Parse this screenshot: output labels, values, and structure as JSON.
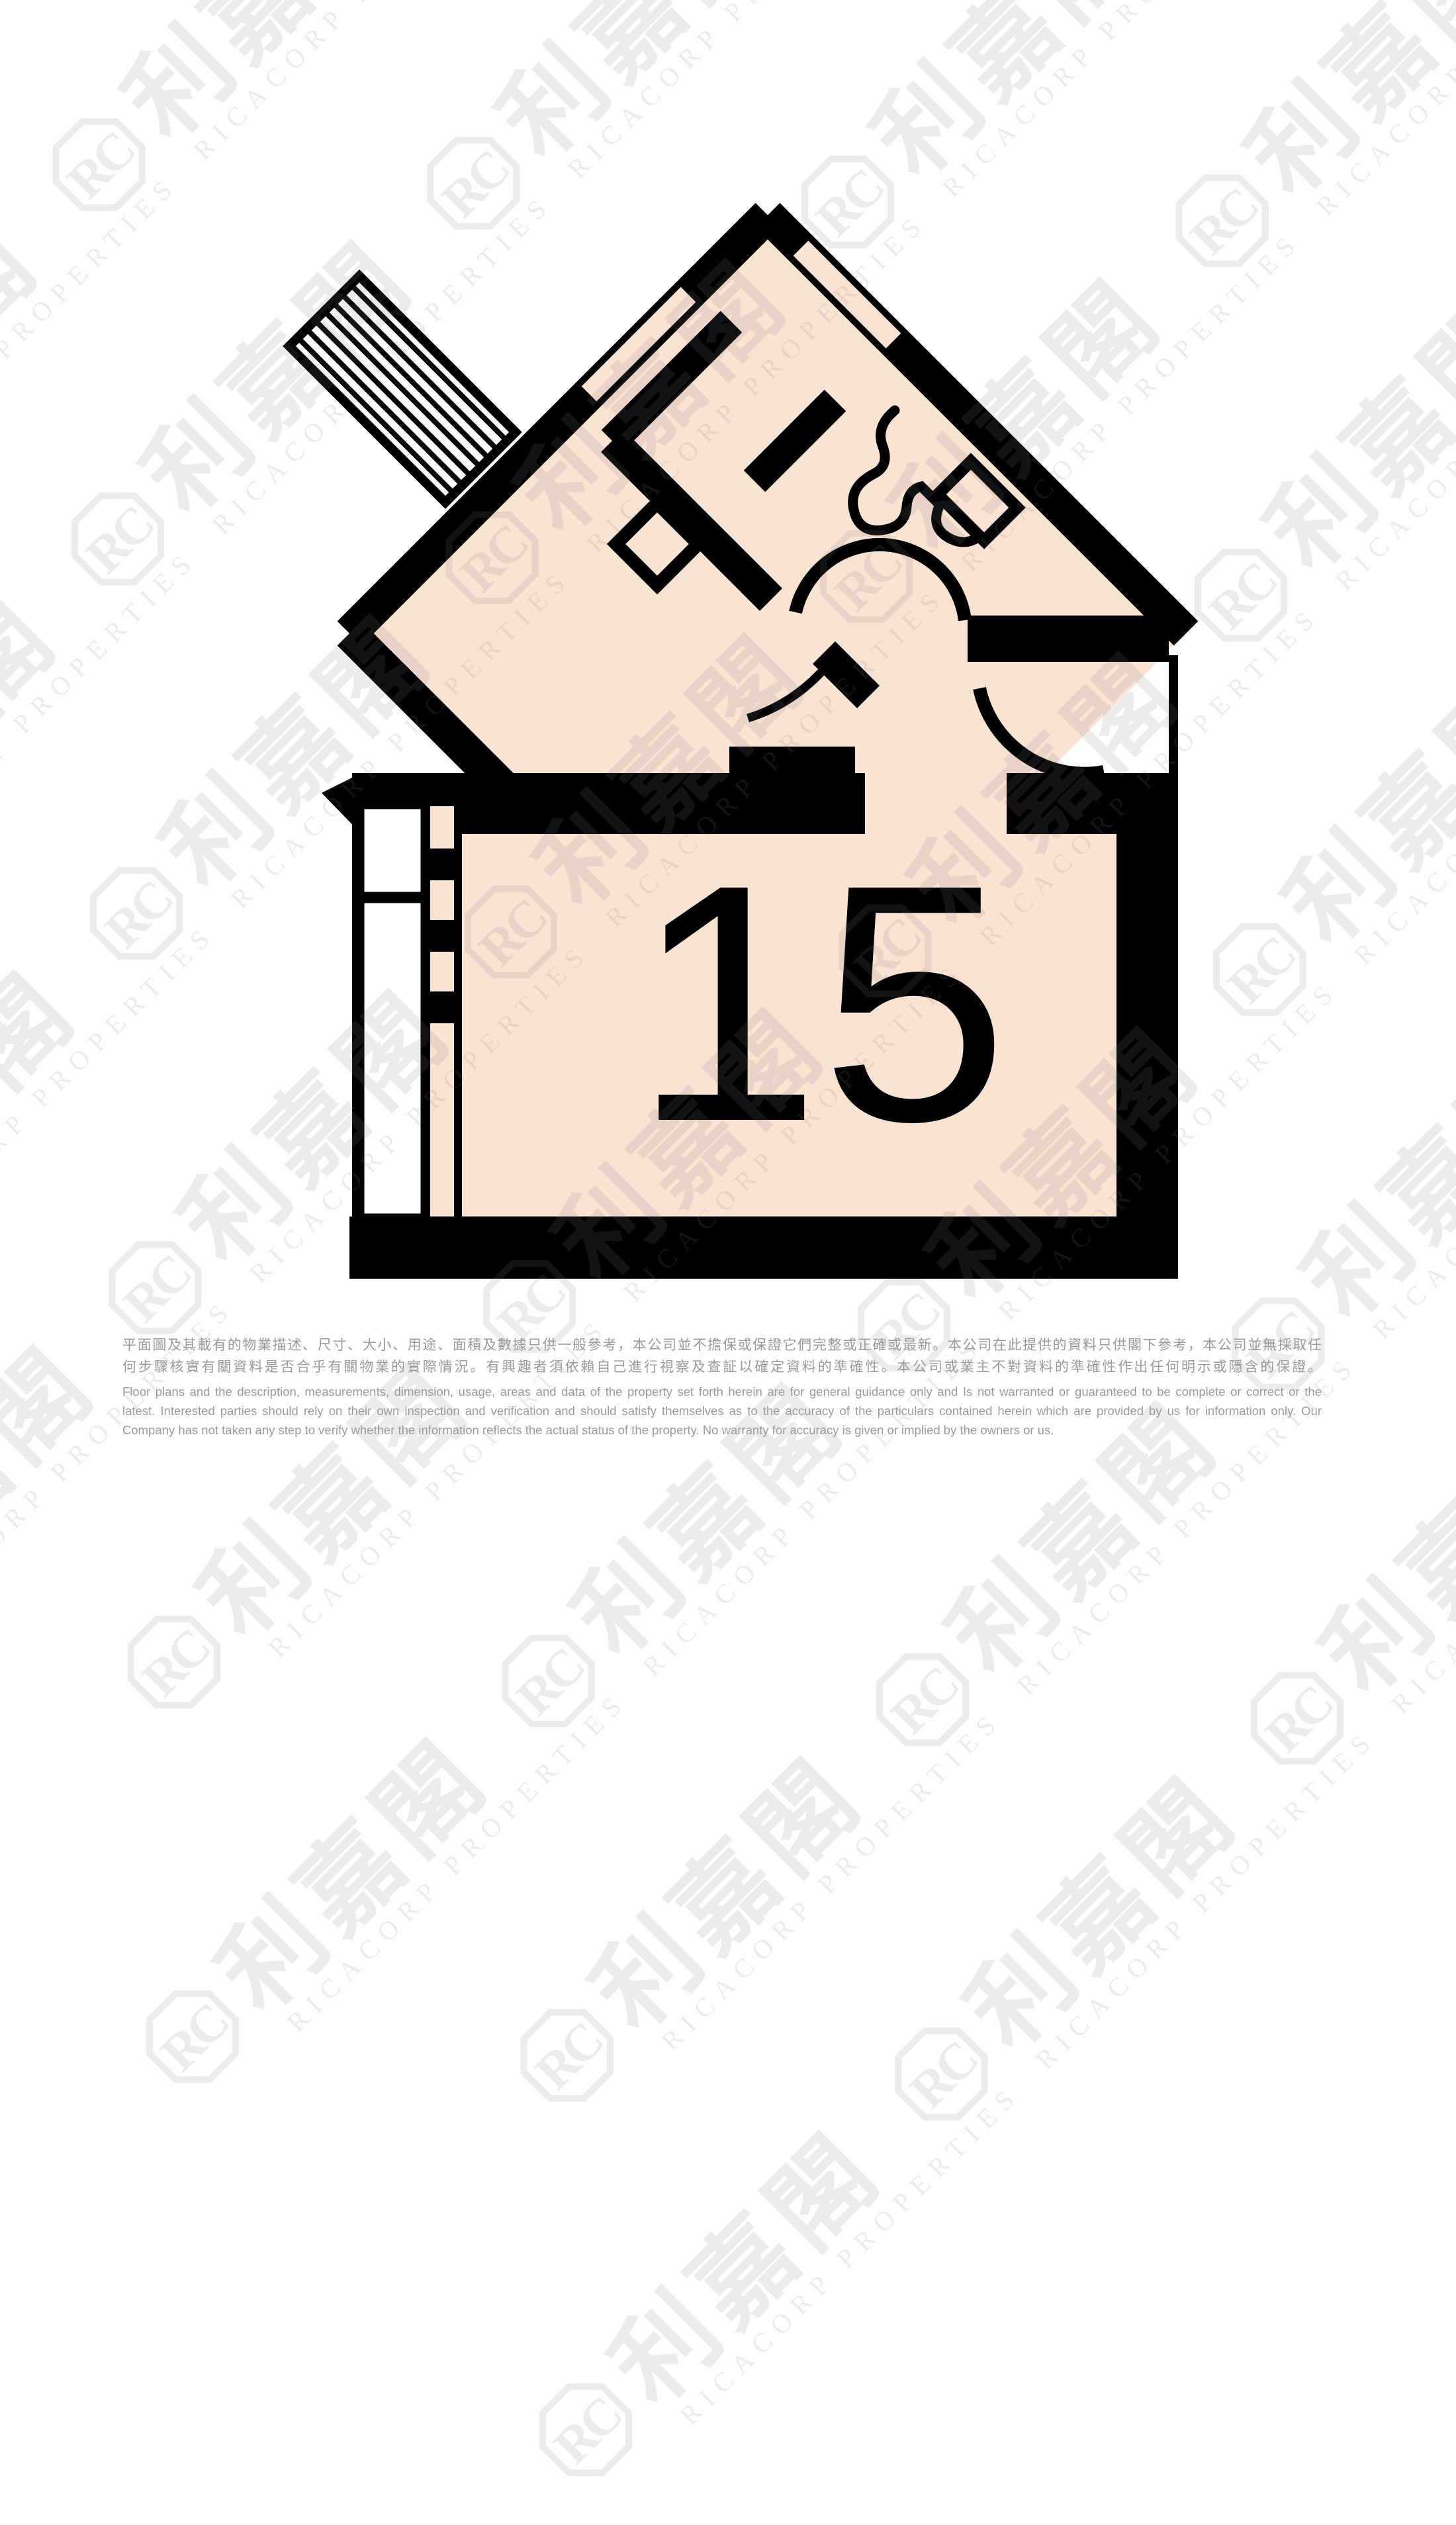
{
  "floor_plan": {
    "unit_number": "15",
    "colors": {
      "room_fill": "#FBE3D4",
      "wall": "#000000",
      "watermark_gray": "#808080",
      "disclaimer_text": "#9b9b9b"
    }
  },
  "watermark": {
    "logo_monogram": "RC",
    "brand_cjk": "利嘉閣",
    "brand_en": "RICACORP PROPERTIES"
  },
  "disclaimer": {
    "zh_lines": [
      "平面圖及其載有的物業描述、尺寸、大小、用途、面積及數據只供一般參考，本公司並不擔保或保證它們完整或正確或最新。本公司在此提供的資料只供閣下參考，本公司並無採取任",
      "何步驟核實有關資料是否合乎有關物業的實際情況。有興趣者須依賴自己進行視察及查証以確定資料的準確性。本公司或業主不對資料的準確性作出任何明示或隱含的保證。"
    ],
    "en_lines": [
      "Floor plans and the description, measurements, dimension, usage, areas and data of the property set forth herein are for general guidance only and Is not warranted or guaranteed to be complete or correct or the",
      "latest. Interested parties should rely on their own inspection and verification and should satisfy themselves as to the accuracy of the particulars contained herein which are provided by us for information only.  Our",
      "Company has not taken any step to verify whether the information reflects the actual status of the property.  No warranty for accuracy is given or implied by the owners or us."
    ]
  }
}
